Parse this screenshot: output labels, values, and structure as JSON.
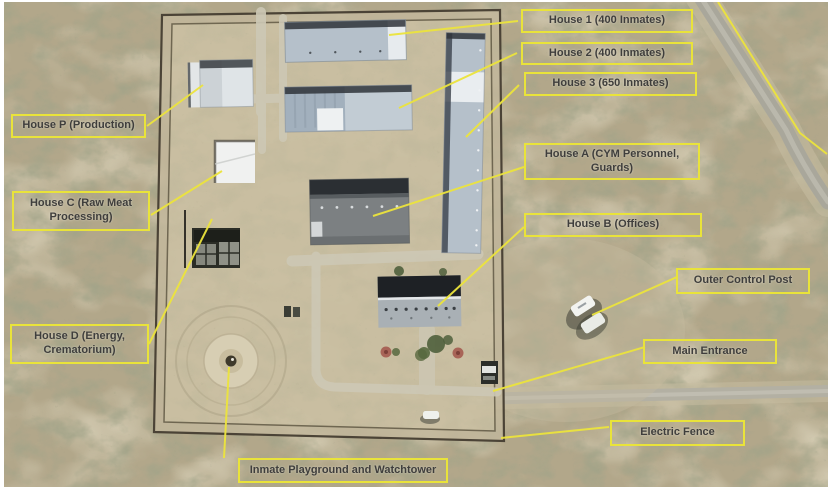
{
  "figure": {
    "kind": "annotated-satellite-image"
  },
  "annotations": {
    "house_1": {
      "label": "House 1 (400 Inmates)"
    },
    "house_2": {
      "label": "House 2 (400 Inmates)"
    },
    "house_3": {
      "label": "House 3 (650 Inmates)"
    },
    "house_p": {
      "label": "House P (Production)"
    },
    "house_c": {
      "label": "House C (Raw Meat Processing)"
    },
    "house_a": {
      "label": "House A (CYM Personnel, Guards)"
    },
    "house_b": {
      "label": "House B (Offices)"
    },
    "house_d": {
      "label": "House D (Energy, Crematorium)"
    },
    "outer_control_post": {
      "label": "Outer Control Post"
    },
    "main_entrance": {
      "label": "Main Entrance"
    },
    "electric_fence": {
      "label": "Electric Fence"
    },
    "playground": {
      "label": "Inmate Playground and Watchtower"
    }
  },
  "colors": {
    "annotation_border": "#e9e33a",
    "annotation_text": "#3f3e3c",
    "terrain_base": "#b2a78a",
    "compound_ground": "#cabfa3",
    "roof_light_blue": "#b5c0ca",
    "roof_dark_gray": "#7c8082",
    "fence_dark": "#4b4336",
    "road_gray": "#b3b0a3",
    "frame_white": "#ffffff"
  }
}
